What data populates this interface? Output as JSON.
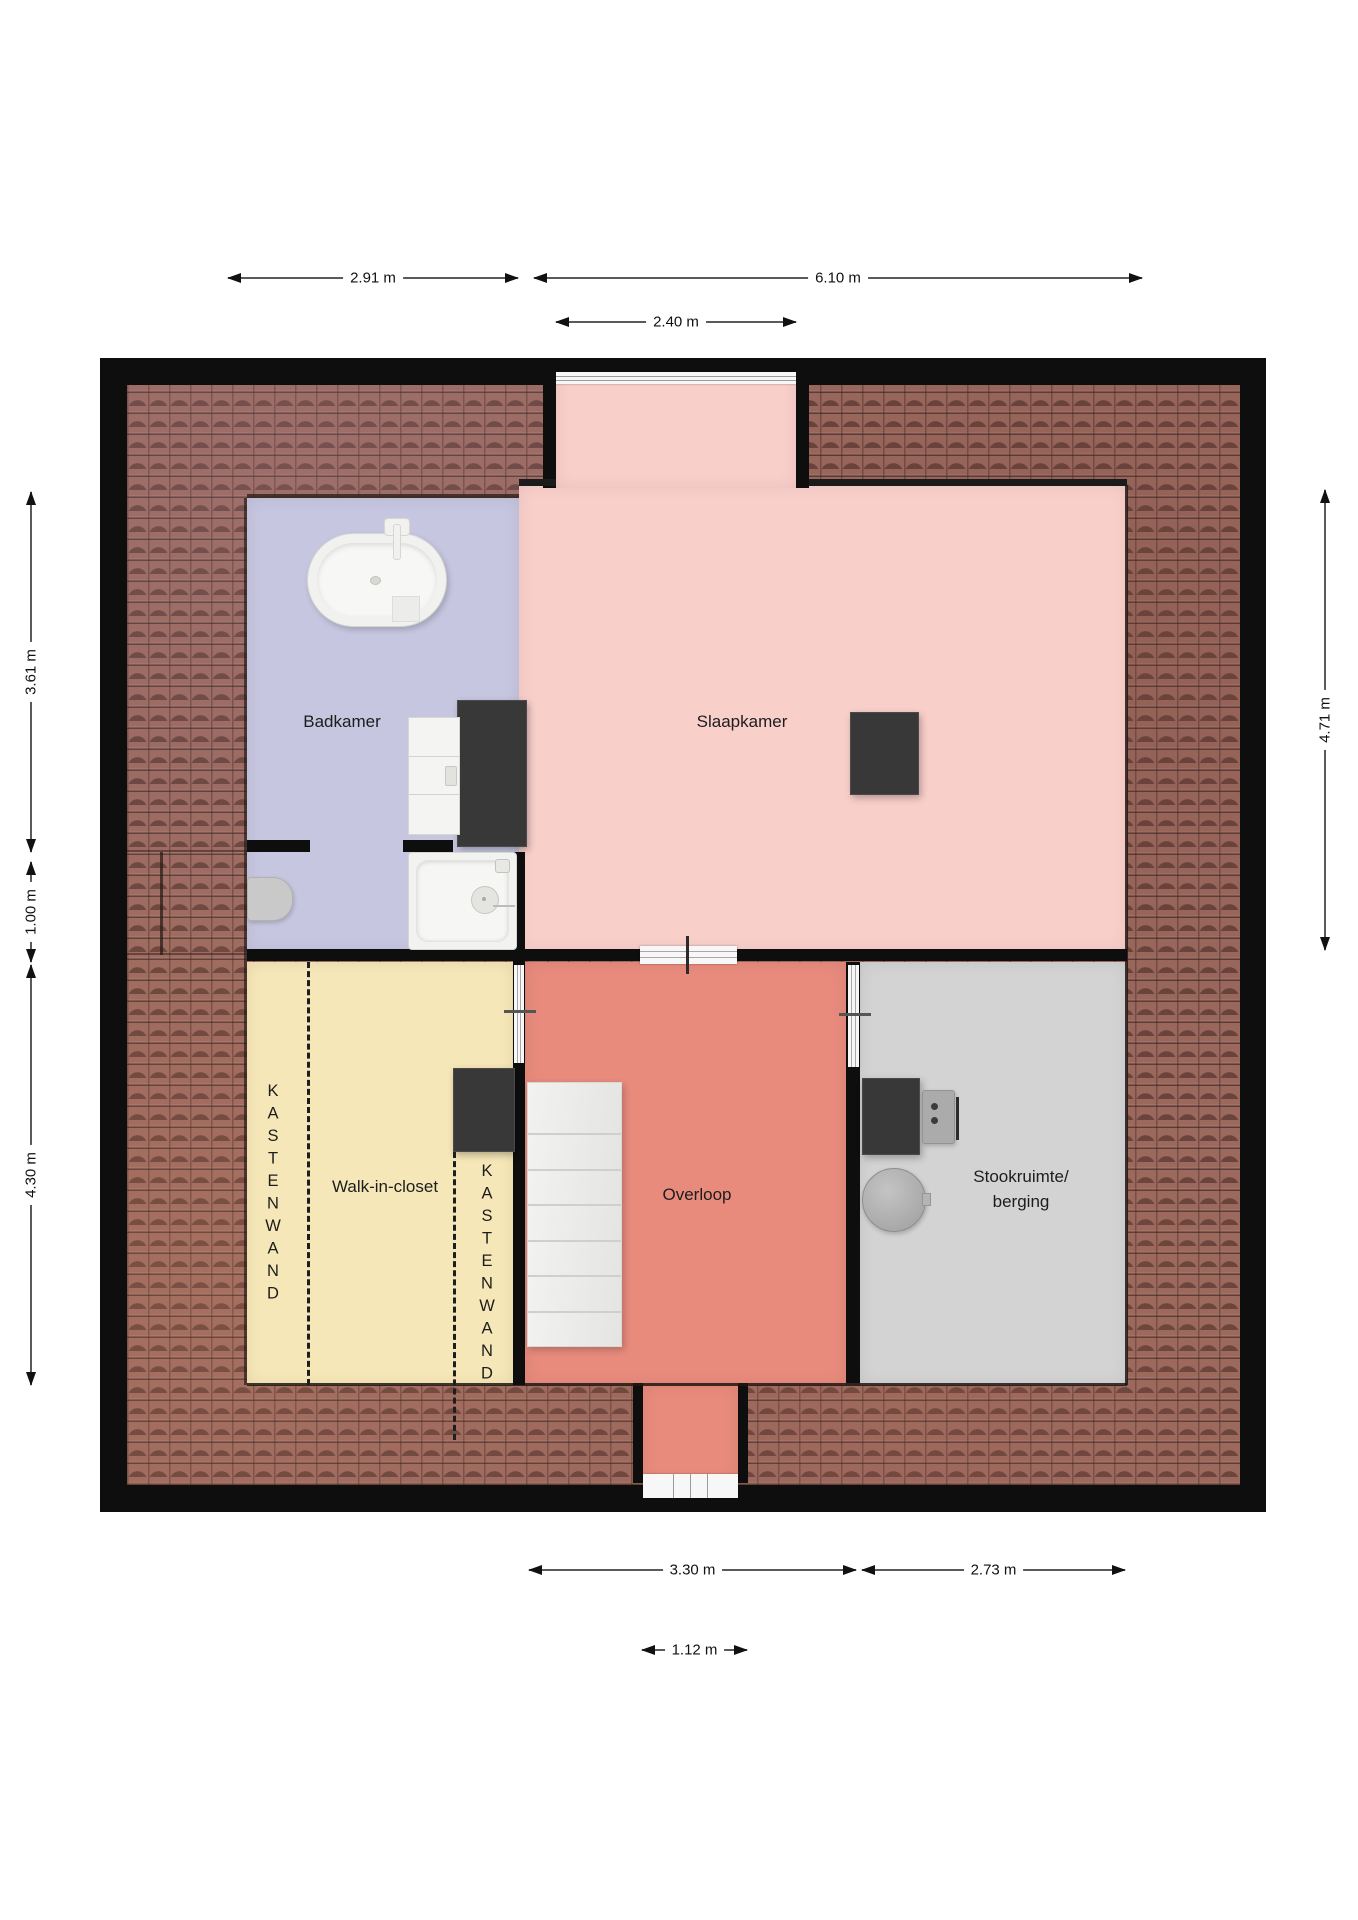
{
  "plan": {
    "rooms": {
      "badkamer": {
        "label": "Badkamer",
        "color": "#c6c6e0"
      },
      "slaapkamer": {
        "label": "Slaapkamer",
        "color": "#f9cfca"
      },
      "walk_in_closet": {
        "label": "Walk-in-closet",
        "color": "#f6e7b8"
      },
      "overloop": {
        "label": "Overloop",
        "color": "#e88b7d"
      },
      "stookruimte": {
        "label_line1": "Stookruimte/",
        "label_line2": "berging",
        "color": "#d3d3d3"
      }
    },
    "closet_wall_label": "KASTENWAND",
    "colors": {
      "wall": "#0e0e0e",
      "roof_tiles": "#9b695e",
      "chimney": "#383838",
      "dimension_line": "#5a5a5a",
      "dimension_text": "#111111"
    }
  },
  "dimensions": {
    "top": {
      "d291": "2.91 m",
      "d610": "6.10 m",
      "d240": "2.40 m"
    },
    "left": {
      "d361": "3.61 m",
      "d100": "1.00 m",
      "d430": "4.30 m"
    },
    "right": {
      "d471": "4.71 m"
    },
    "bottom": {
      "d330": "3.30 m",
      "d273": "2.73 m",
      "d112": "1.12 m"
    }
  }
}
